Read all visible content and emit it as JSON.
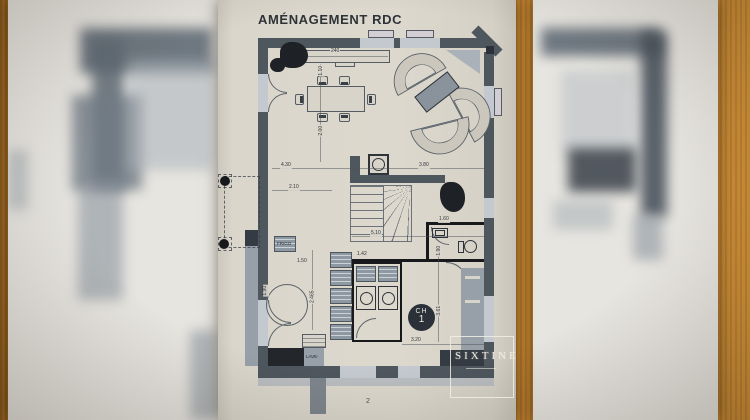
{
  "scene": {
    "description": "Photo of an architect ground-floor plan sheet lying on a wooden table, flanked by two blurred plan sheets",
    "wood_hex": "#a96f23",
    "blurred_paper_hex": "#e7e5e0",
    "sheet_hex": "#dcd8cd",
    "wall_hex": "#4e565e",
    "heavy_wall_hex": "#17191d",
    "furniture_gray_hex": "#8e98a2",
    "ink_hex": "#2e3338"
  },
  "plan": {
    "title": "AMÉNAGEMENT RDC",
    "page_number": "2",
    "bedroom": {
      "label_top": "CH",
      "label_num": "1"
    },
    "logo": {
      "text": "SIXTINE"
    },
    "labels": {
      "fridge": "FRIGO",
      "counter": "LAVE-"
    },
    "dimensions": [
      "240",
      "1.10",
      "2.00",
      "4.30",
      "3.80",
      "2.10",
      "5.10",
      "1.60",
      "1.90",
      "1.42",
      "2.465",
      "1.50",
      "3.61",
      "3.20",
      "1.90"
    ]
  }
}
